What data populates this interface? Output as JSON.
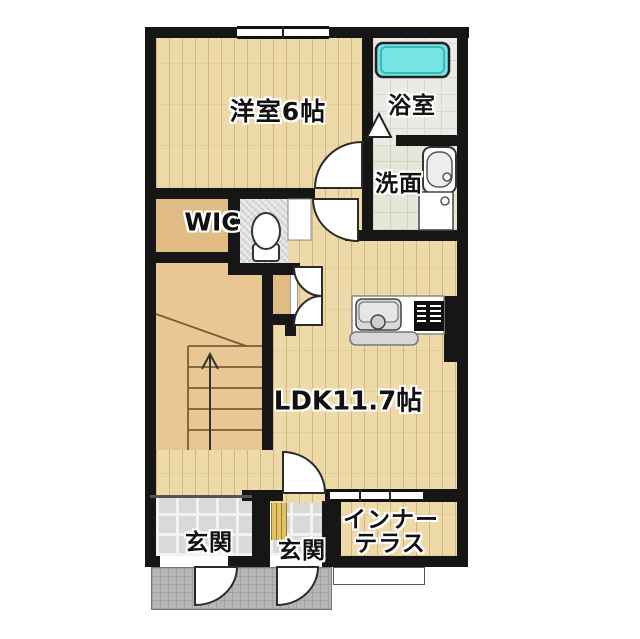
{
  "plan_title": "1LDK apartment floor plan",
  "rooms": {
    "western_room": {
      "label": "洋室6帖"
    },
    "bathroom": {
      "label": "浴室"
    },
    "washroom": {
      "label": "洗面"
    },
    "wic": {
      "label": "WIC"
    },
    "ldk": {
      "label": "LDK11.7帖"
    },
    "entrance_left": {
      "label": "玄関"
    },
    "entrance_right": {
      "label": "玄関"
    },
    "inner_terrace": {
      "label_line1": "インナー",
      "label_line2": "テラス"
    }
  },
  "fixtures": [
    {
      "name": "bathtub"
    },
    {
      "name": "vanity-sink"
    },
    {
      "name": "washing-machine"
    },
    {
      "name": "toilet"
    },
    {
      "name": "kitchen-sink"
    },
    {
      "name": "stove"
    },
    {
      "name": "kitchen-counter"
    },
    {
      "name": "staircase-up-arrow"
    },
    {
      "name": "entrance-doors"
    },
    {
      "name": "shoe-rack"
    },
    {
      "name": "window"
    },
    {
      "name": "sliding-window"
    }
  ],
  "colors": {
    "wall": "#161616",
    "wood_floor": "#eed9a9",
    "stair_floor": "#e9c795",
    "bathtub": "#74e4e4",
    "bath_tile": "#eceae4",
    "washroom_tile": "#e4e8d9",
    "genkan_tile": "#d9d9d9",
    "porch_tile": "#b7b7b7",
    "shoe_rack": "#e3c266"
  }
}
